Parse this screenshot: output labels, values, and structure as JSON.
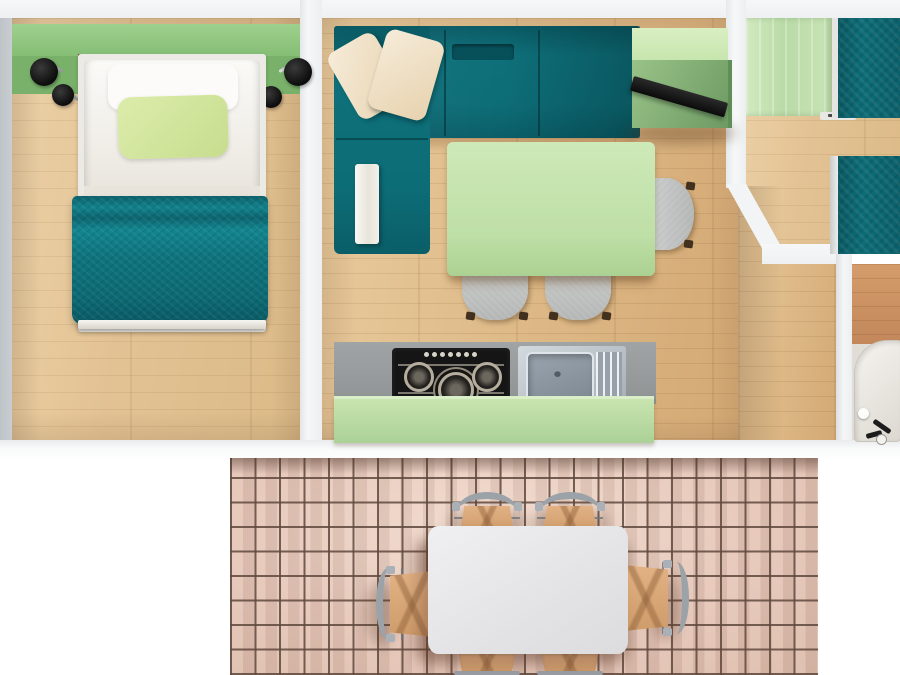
{
  "scene": {
    "name": "apartment-floor-plan-3d-top-view",
    "rooms": [
      {
        "name": "bedroom-left",
        "furniture": [
          "headboard-shelf",
          "wall-lamp-left",
          "wall-lamp-right",
          "single-bed",
          "white-sheet",
          "white-pillow",
          "green-pillow",
          "teal-quilt",
          "bed-end-rail",
          "wood-floor"
        ]
      },
      {
        "name": "living-room",
        "furniture": [
          "teal-corner-sofa",
          "cream-cushion-1",
          "cream-cushion-2",
          "folded-throw",
          "green-desk",
          "black-laptop",
          "green-dining-table",
          "gray-chair-right",
          "gray-chair-bottom-1",
          "gray-chair-bottom-2",
          "wood-floor"
        ]
      },
      {
        "name": "kitchen",
        "furniture": [
          "gray-countertop",
          "gas-hob",
          "hob-knobs",
          "steel-sink",
          "drainboard",
          "green-cabinet-front"
        ]
      },
      {
        "name": "bedroom-right",
        "furniture": [
          "green-wardrobe",
          "twin-bed-top",
          "twin-bed-bottom",
          "wood-floor",
          "angled-wall"
        ]
      },
      {
        "name": "bathroom",
        "furniture": [
          "wood-counter",
          "shower-tray",
          "black-faucet",
          "drain"
        ]
      },
      {
        "name": "terrace",
        "furniture": [
          "terracotta-tile-floor",
          "white-dining-table",
          "patio-chair-top-1",
          "patio-chair-top-2",
          "patio-chair-left",
          "patio-chair-right",
          "patio-chair-bottom-1",
          "patio-chair-bottom-2"
        ]
      }
    ]
  },
  "colors": {
    "bg": "#ffffff",
    "wall": "#eef0f2",
    "wall_shadow": "#c9cdd1",
    "wood_a": "#ecd2a8",
    "wood_b": "#ddb886",
    "wood_red": "#c2875a",
    "green_shelf": "#84bd74",
    "green_dark": "#79b16a",
    "green_wardrobe": "#b9dba6",
    "green_desk": "#c6e5ad",
    "green_desk_side": "#6e9b63",
    "green_table": "#bedfa6",
    "green_cabinet": "#abd196",
    "pillow_green": "#c7dd8e",
    "teal": "#0d6d77",
    "teal_dark": "#0a5a64",
    "teal_light": "#12828c",
    "cream": "#e7d2ae",
    "counter": "#8f9394",
    "hob": "#151515",
    "steel": "#d3dadf",
    "steel_dark": "#7e8993",
    "chair_gray": "#b3b6b5",
    "leg_brown": "#42311f",
    "tile": "#e6c6b7",
    "grout": "#5f483d",
    "patio_table": "#e3e3e5",
    "metal": "#9ba2a8",
    "wicker": "#cf9c6a"
  }
}
